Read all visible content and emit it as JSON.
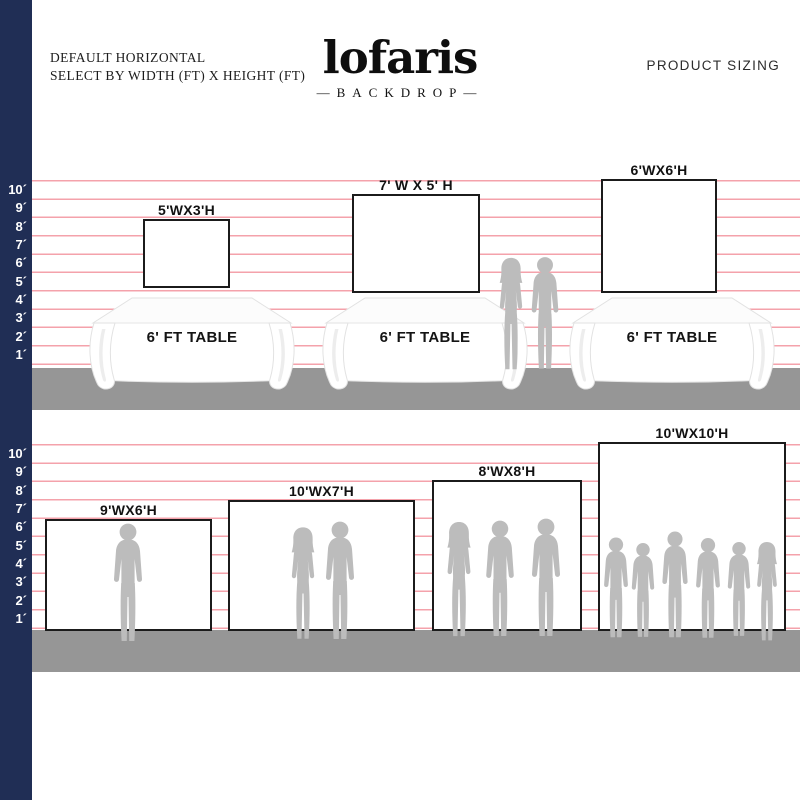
{
  "header": {
    "subtitle_line1": "DEFAULT HORIZONTAL",
    "subtitle_line2": "SELECT BY WIDTH (FT) X HEIGHT (FT)",
    "logo": "lofaris",
    "logo_tagline": "—BACKDROP—",
    "product_sizing": "PRODUCT SIZING"
  },
  "ruler_row1": [
    "10´",
    "9´",
    "8´",
    "7´",
    "6´",
    "5´",
    "4´",
    "3´",
    "2´",
    "1´"
  ],
  "ruler_row2": [
    "10´",
    "9´",
    "8´",
    "7´",
    "6´",
    "5´",
    "4´",
    "3´",
    "2´",
    "1´"
  ],
  "row1": {
    "backdrops": [
      {
        "label": "5'WX3'H"
      },
      {
        "label": "7' W X 5' H"
      },
      {
        "label": "6'WX6'H"
      }
    ],
    "tables": [
      {
        "label": "6' FT TABLE"
      },
      {
        "label": "6' FT TABLE"
      },
      {
        "label": "6' FT TABLE"
      }
    ]
  },
  "row2": {
    "backdrops": [
      {
        "label": "9'WX6'H"
      },
      {
        "label": "10'WX7'H"
      },
      {
        "label": "8'WX8'H"
      },
      {
        "label": "10'WX10'H"
      }
    ]
  },
  "colors": {
    "ruler_bar_navy": "#202e55",
    "grid_line_pink": "#f4a2ab",
    "floor_gray": "#969696",
    "silhouette_gray": "#bcbcbc",
    "backdrop_border": "#1b1b1b"
  }
}
